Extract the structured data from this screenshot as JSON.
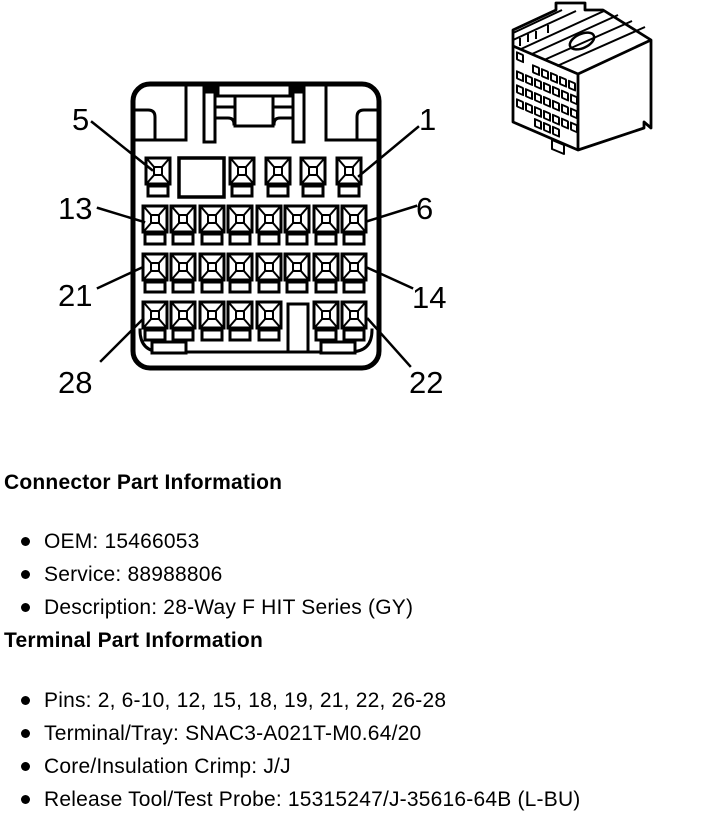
{
  "colors": {
    "line": "#000000",
    "background": "#ffffff",
    "text": "#000000"
  },
  "diagram": {
    "pin_labels": [
      "5",
      "1",
      "13",
      "6",
      "21",
      "14",
      "28",
      "22"
    ]
  },
  "sections": [
    {
      "heading": "Connector Part Information",
      "items": [
        "OEM: 15466053",
        "Service: 88988806",
        "Description: 28-Way F HIT Series (GY)"
      ]
    },
    {
      "heading": "Terminal Part Information",
      "items": [
        "Pins: 2, 6-10, 12, 15, 18, 19, 21, 22, 26-28",
        "Terminal/Tray: SNAC3-A021T-M0.64/20",
        "Core/Insulation Crimp: J/J",
        "Release Tool/Test Probe: 15315247/J-35616-64B (L-BU)"
      ]
    }
  ]
}
